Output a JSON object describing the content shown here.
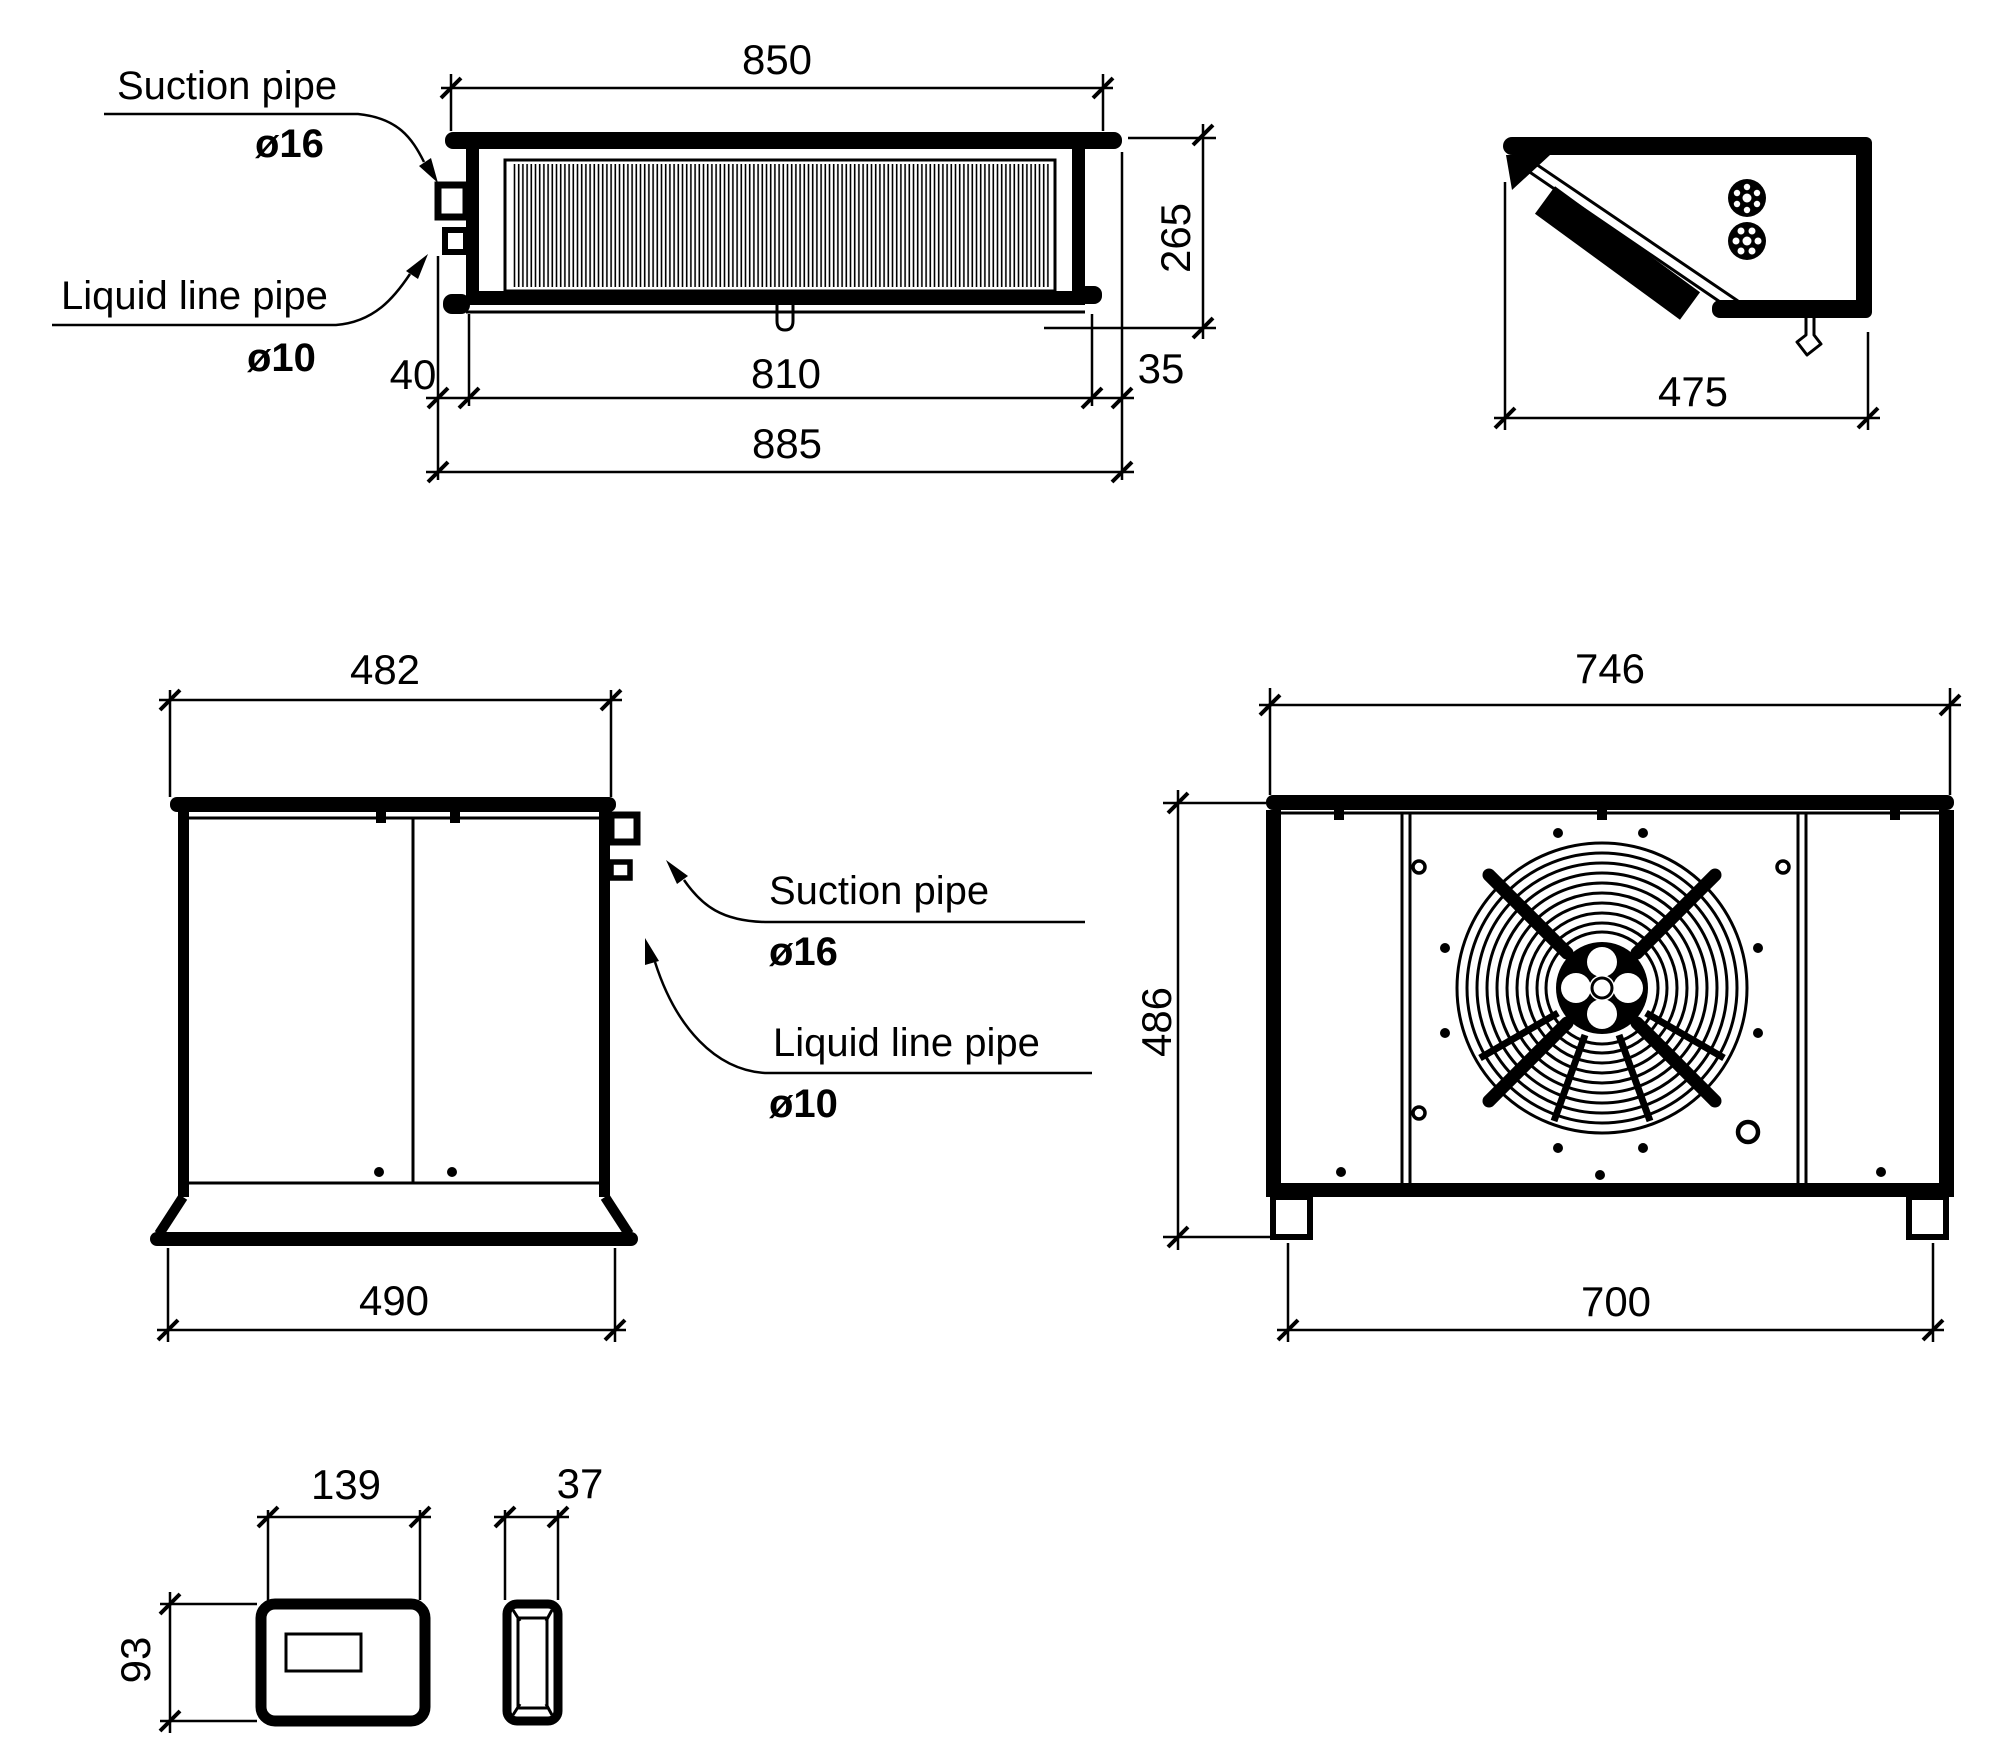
{
  "page": {
    "background_color": "#ffffff",
    "line_color": "#000000",
    "type": "technical dimension drawing"
  },
  "pipe_labels": {
    "suction": "Suction pipe",
    "suction_dia": "ø16",
    "liquid": "Liquid line pipe",
    "liquid_dia": "ø10"
  },
  "evaporator_top_view": {
    "dim_overall_width": "850",
    "dim_depth": "265",
    "dim_pipe_offset": "40",
    "dim_coil_width": "810",
    "dim_right_offset": "35",
    "dim_total_width": "885"
  },
  "evaporator_side_view": {
    "dim_depth": "475"
  },
  "evaporator_front_view": {
    "dim_top_width": "482",
    "dim_bottom_width": "490"
  },
  "condensing_unit_front_view": {
    "dim_top_width": "746",
    "dim_height": "486",
    "dim_feet_span": "700"
  },
  "controller_box": {
    "dim_width": "139",
    "dim_depth": "37",
    "dim_height": "93"
  }
}
